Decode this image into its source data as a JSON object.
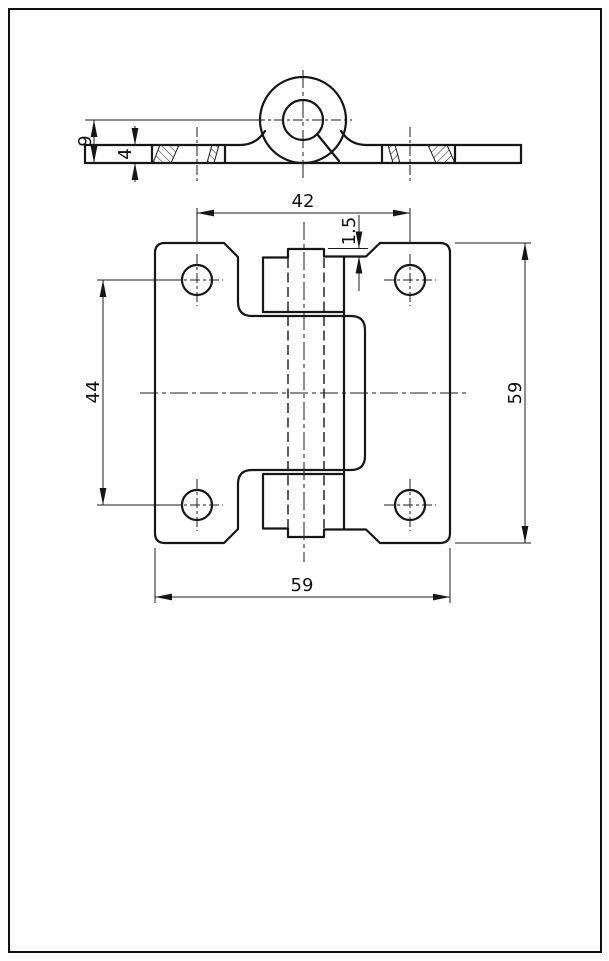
{
  "dimensions": {
    "front": {
      "hole_spacing_h": "42",
      "gap": "1.5",
      "hole_spacing_v": "44",
      "height": "59",
      "width": "59"
    },
    "section": {
      "knuckle_height": "9",
      "thickness": "4"
    }
  }
}
